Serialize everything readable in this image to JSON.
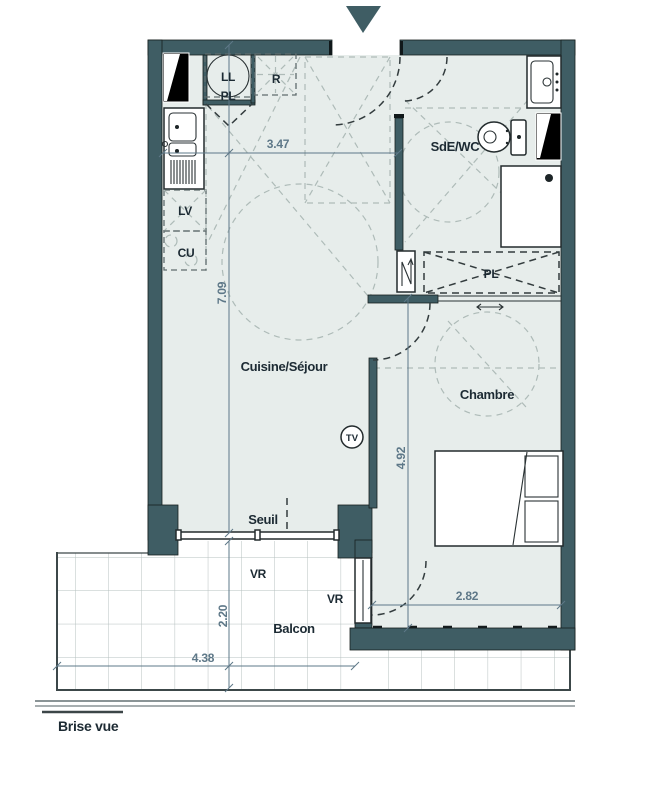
{
  "colors": {
    "wall": "#3f5d64",
    "floor": "#e7edeb",
    "dim": "#5e7888",
    "label": "#1c2a33",
    "light": "#aebbb8",
    "tile": "#b6c0bf",
    "gray": "#8a9496"
  },
  "icons": {
    "entrance_arrow": "triangle-down",
    "sliding_door_arrow": "left-right-arrow"
  },
  "labels": {
    "kitchen_living": "Cuisine/Séjour",
    "bedroom": "Chambre",
    "shower_wc": "SdE/WC",
    "balcony": "Balcon",
    "threshold": "Seuil",
    "privacy_screen": "Brise vue",
    "roller_shutter_left": "VR",
    "roller_shutter_right": "VR"
  },
  "fixtures": {
    "washing_machine": "LL",
    "entry_closet": "PL",
    "fridge": "R",
    "dishwasher": "LV",
    "cooktop": "CU",
    "bedroom_closet": "PL",
    "tv": "TV"
  },
  "dimensions": {
    "living_width": "3.47",
    "apartment_depth": "7.09",
    "bedroom_depth": "4.92",
    "bedroom_width": "2.82",
    "balcony_depth": "2.20",
    "balcony_width": "4.38"
  }
}
